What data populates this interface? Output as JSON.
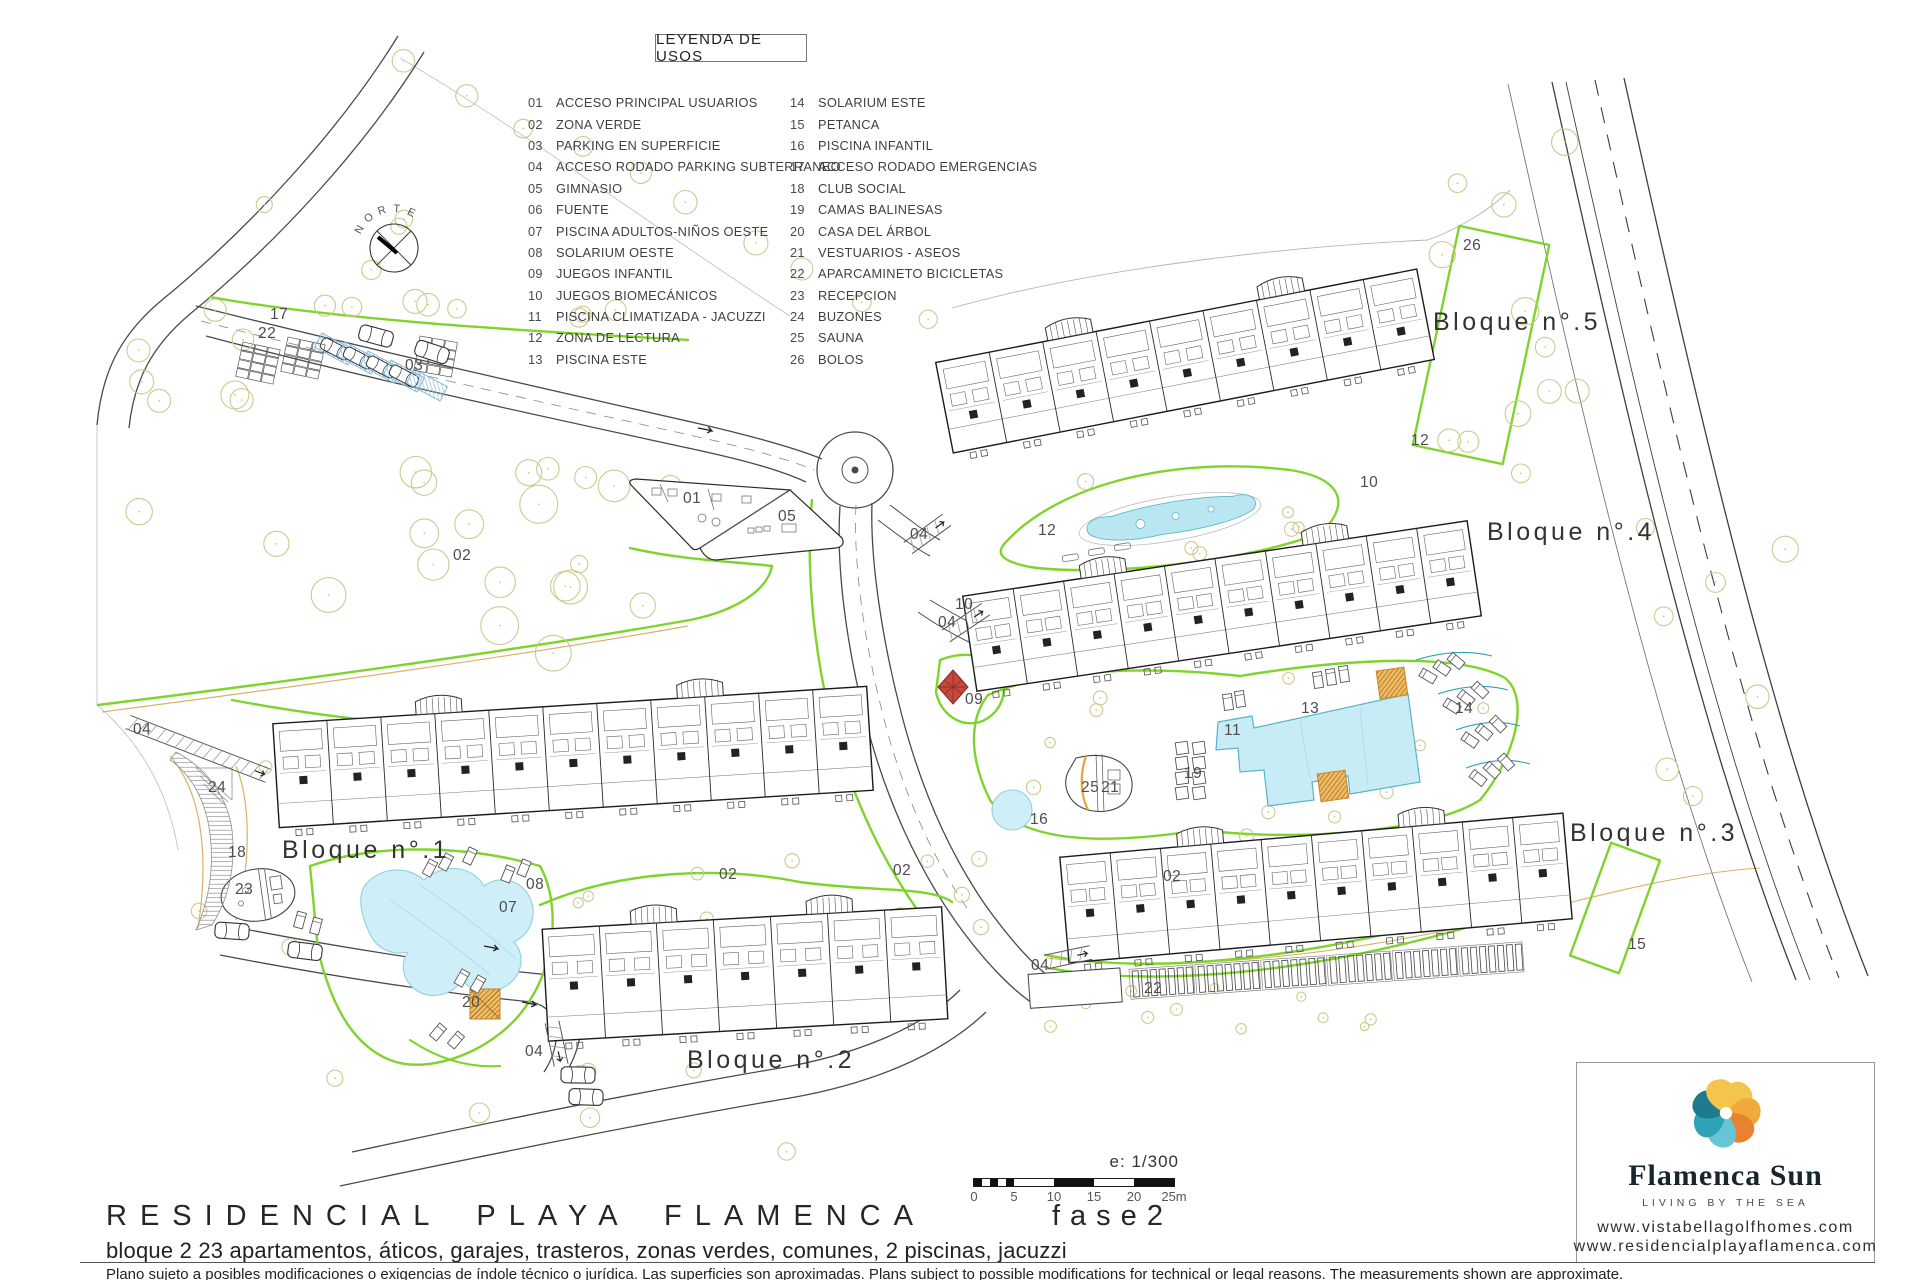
{
  "legend": {
    "title": "LEYENDA DE USOS",
    "items": [
      {
        "num": "01",
        "label": "ACCESO PRINCIPAL USUARIOS"
      },
      {
        "num": "02",
        "label": "ZONA VERDE"
      },
      {
        "num": "03",
        "label": "PARKING EN SUPERFICIE"
      },
      {
        "num": "04",
        "label": "ACCESO RODADO PARKING SUBTERRANEO"
      },
      {
        "num": "05",
        "label": "GIMNASIO"
      },
      {
        "num": "06",
        "label": "FUENTE"
      },
      {
        "num": "07",
        "label": "PISCINA ADULTOS-NIÑOS OESTE"
      },
      {
        "num": "08",
        "label": "SOLARIUM OESTE"
      },
      {
        "num": "09",
        "label": "JUEGOS INFANTIL"
      },
      {
        "num": "10",
        "label": "JUEGOS BIOMECÁNICOS"
      },
      {
        "num": "11",
        "label": "PISCINA CLIMATIZADA - JACUZZI"
      },
      {
        "num": "12",
        "label": "ZONA DE LECTURA"
      },
      {
        "num": "13",
        "label": "PISCINA ESTE"
      },
      {
        "num": "14",
        "label": "SOLARIUM ESTE"
      },
      {
        "num": "15",
        "label": "PETANCA"
      },
      {
        "num": "16",
        "label": "PISCINA INFANTIL"
      },
      {
        "num": "17",
        "label": "ACCESO RODADO EMERGENCIAS"
      },
      {
        "num": "18",
        "label": "CLUB SOCIAL"
      },
      {
        "num": "19",
        "label": "CAMAS BALINESAS"
      },
      {
        "num": "20",
        "label": "CASA DEL ÁRBOL"
      },
      {
        "num": "21",
        "label": "VESTUARIOS - ASEOS"
      },
      {
        "num": "22",
        "label": "APARCAMINETO BICICLETAS"
      },
      {
        "num": "23",
        "label": "RECEPCION"
      },
      {
        "num": "24",
        "label": "BUZONES"
      },
      {
        "num": "25",
        "label": "SAUNA"
      },
      {
        "num": "26",
        "label": "BOLOS"
      }
    ]
  },
  "plan": {
    "north_letters": "NORTE",
    "bloques": [
      {
        "label": "Bloque n°.1",
        "x": 282,
        "y": 858
      },
      {
        "label": "Bloque n°.2",
        "x": 687,
        "y": 1068
      },
      {
        "label": "Bloque n°.3",
        "x": 1570,
        "y": 841
      },
      {
        "label": "Bloque n°.4",
        "x": 1487,
        "y": 540
      },
      {
        "label": "Bloque n°.5",
        "x": 1433,
        "y": 330
      }
    ],
    "zone_labels": [
      {
        "n": "17",
        "x": 270,
        "y": 319
      },
      {
        "n": "22",
        "x": 258,
        "y": 338
      },
      {
        "n": "03",
        "x": 405,
        "y": 370
      },
      {
        "n": "01",
        "x": 683,
        "y": 503
      },
      {
        "n": "05",
        "x": 778,
        "y": 521
      },
      {
        "n": "02",
        "x": 453,
        "y": 560
      },
      {
        "n": "02",
        "x": 719,
        "y": 879
      },
      {
        "n": "02",
        "x": 893,
        "y": 875
      },
      {
        "n": "02",
        "x": 1163,
        "y": 881
      },
      {
        "n": "04",
        "x": 133,
        "y": 734
      },
      {
        "n": "04",
        "x": 910,
        "y": 539
      },
      {
        "n": "04",
        "x": 938,
        "y": 627
      },
      {
        "n": "04",
        "x": 1031,
        "y": 970
      },
      {
        "n": "04",
        "x": 525,
        "y": 1056
      },
      {
        "n": "10",
        "x": 955,
        "y": 609
      },
      {
        "n": "10",
        "x": 1360,
        "y": 487
      },
      {
        "n": "12",
        "x": 1038,
        "y": 535
      },
      {
        "n": "12",
        "x": 1411,
        "y": 445
      },
      {
        "n": "09",
        "x": 965,
        "y": 704
      },
      {
        "n": "16",
        "x": 1030,
        "y": 824
      },
      {
        "n": "11",
        "x": 1224,
        "y": 735
      },
      {
        "n": "13",
        "x": 1301,
        "y": 713
      },
      {
        "n": "14",
        "x": 1455,
        "y": 713
      },
      {
        "n": "19",
        "x": 1184,
        "y": 778
      },
      {
        "n": "25",
        "x": 1081,
        "y": 792
      },
      {
        "n": "21",
        "x": 1101,
        "y": 792
      },
      {
        "n": "22",
        "x": 1144,
        "y": 993
      },
      {
        "n": "15",
        "x": 1628,
        "y": 949
      },
      {
        "n": "26",
        "x": 1463,
        "y": 250
      },
      {
        "n": "18",
        "x": 228,
        "y": 857
      },
      {
        "n": "23",
        "x": 235,
        "y": 894
      },
      {
        "n": "24",
        "x": 208,
        "y": 792
      },
      {
        "n": "08",
        "x": 526,
        "y": 889
      },
      {
        "n": "07",
        "x": 499,
        "y": 912
      },
      {
        "n": "20",
        "x": 462,
        "y": 1007
      }
    ]
  },
  "scale_bar": {
    "ratio": "e: 1/300",
    "ticks": [
      "0",
      "5",
      "10",
      "15",
      "20",
      "25m"
    ]
  },
  "footer": {
    "project": "RESIDENCIAL PLAYA FLAMENCA",
    "phase": "fase2",
    "details": "bloque 2   23 apartamentos, áticos, garajes, trasteros, zonas verdes, comunes, 2 piscinas, jacuzzi",
    "disclaimer": "Plano sujeto a posibles modificaciones o exigencias de índole técnico o jurídica. Las superficies son aproximadas. Plans subject to possible modifications for technical or legal reasons. The measurements shown are approximate."
  },
  "brand": {
    "name": "Flamenca Sun",
    "tagline": "LIVING BY THE SEA",
    "urls": [
      "www.vistabellagolfhomes.com",
      "www.residencialplayaflamenca.com"
    ],
    "colors": {
      "gold": "#F3C64B",
      "amber": "#F0A93C",
      "orange": "#E8822E",
      "sky": "#66C6D6",
      "teal": "#2FA3B5",
      "deep_teal": "#1E7A8C",
      "green_line": "#7FD32B",
      "tree": "#CEC98E",
      "pool": "#C8ECF6",
      "pool_edge": "#57B4CB",
      "tan": "#D8B266"
    }
  }
}
